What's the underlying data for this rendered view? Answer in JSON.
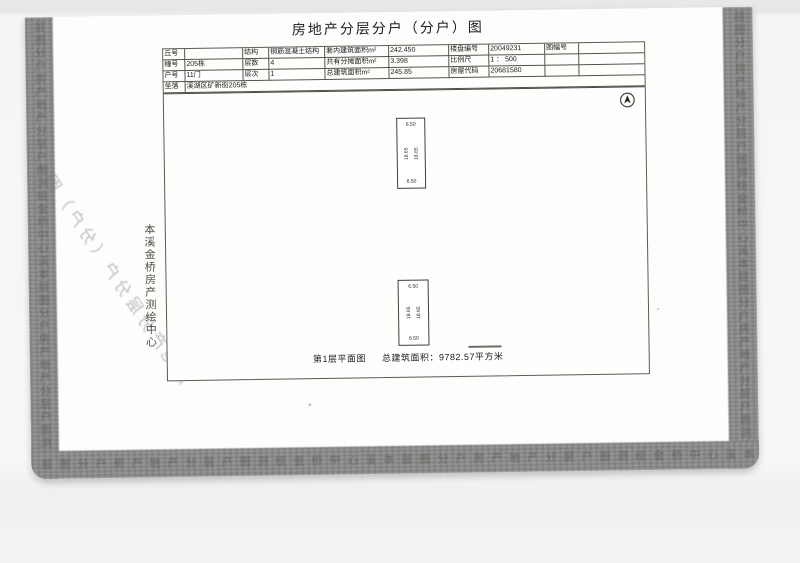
{
  "title": "房地产分层分户（分户）图",
  "table": {
    "rows": [
      {
        "cells": [
          "丘号",
          "",
          "结构",
          "钢筋混凝土结构",
          "套内建筑面积m²",
          "242.450",
          "楼盘编号",
          "20049231",
          "图幅号",
          ""
        ]
      },
      {
        "cells": [
          "幢号",
          "205栋",
          "层数",
          "4",
          "共有分摊面积m²",
          "3.398",
          "比例尺",
          "1 ： 500",
          "",
          ""
        ]
      },
      {
        "cells": [
          "户号",
          "11门",
          "层次",
          "1",
          "总建筑面积m²",
          "245.85",
          "房屋代码",
          "20681580",
          "",
          ""
        ]
      }
    ],
    "location_label": "坐落",
    "location_value": "溪湖区矿新街205栋"
  },
  "plan": {
    "unit1": {
      "top_dim": "6.50",
      "bottom_dim": "6.50",
      "left_dim": "18.65",
      "right_dim": "18.65"
    },
    "unit2": {
      "top_dim": "6.50",
      "bottom_dim": "6.50",
      "left_dim": "18.65",
      "right_dim": "18.65"
    },
    "caption_left": "第1层平面图",
    "caption_right": "总建筑面积：9782.57平方米"
  },
  "stamps": {
    "surveyor_vertical": "本溪金桥房产测绘中心",
    "diagonal_bleedthrough": "房地产分层分户（分户）图"
  },
  "scan": {
    "band_color": "#8d8d8b",
    "ghost_glyphs": "层图分户房产地产分层户图测绘金桥中心溪本"
  }
}
